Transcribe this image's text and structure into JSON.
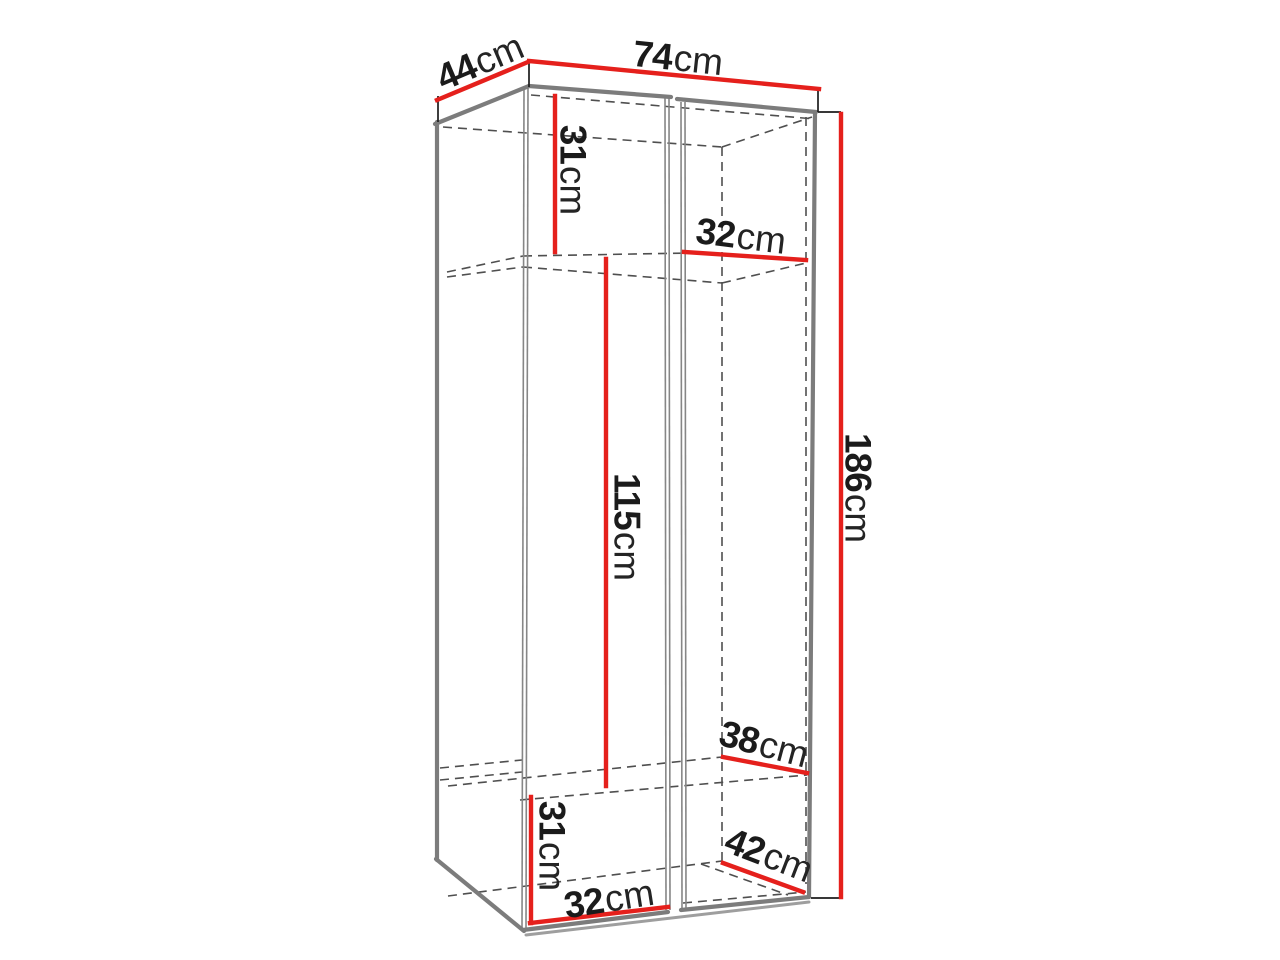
{
  "diagram": {
    "type": "furniture-dimension-diagram",
    "subject": "two-door wardrobe technical line drawing with dimension callouts",
    "unit": "cm",
    "colors": {
      "dimension_line": "#e5201c",
      "outline_gray": "#7c7c7c",
      "hidden_edge_gray": "#4f4f4f",
      "label_text": "#1b1b1b",
      "background": "#ffffff"
    },
    "dimensions": [
      {
        "id": "top-depth",
        "value": "44",
        "unit": "cm"
      },
      {
        "id": "top-width",
        "value": "74",
        "unit": "cm"
      },
      {
        "id": "upper-section-height",
        "value": "31",
        "unit": "cm"
      },
      {
        "id": "upper-shelf-depth",
        "value": "32",
        "unit": "cm"
      },
      {
        "id": "middle-section-height",
        "value": "115",
        "unit": "cm"
      },
      {
        "id": "total-height",
        "value": "186",
        "unit": "cm"
      },
      {
        "id": "lower-shelf-depth",
        "value": "38",
        "unit": "cm"
      },
      {
        "id": "lower-section-height",
        "value": "31",
        "unit": "cm"
      },
      {
        "id": "bottom-shelf-width",
        "value": "32",
        "unit": "cm"
      },
      {
        "id": "bottom-depth",
        "value": "42",
        "unit": "cm"
      }
    ]
  }
}
